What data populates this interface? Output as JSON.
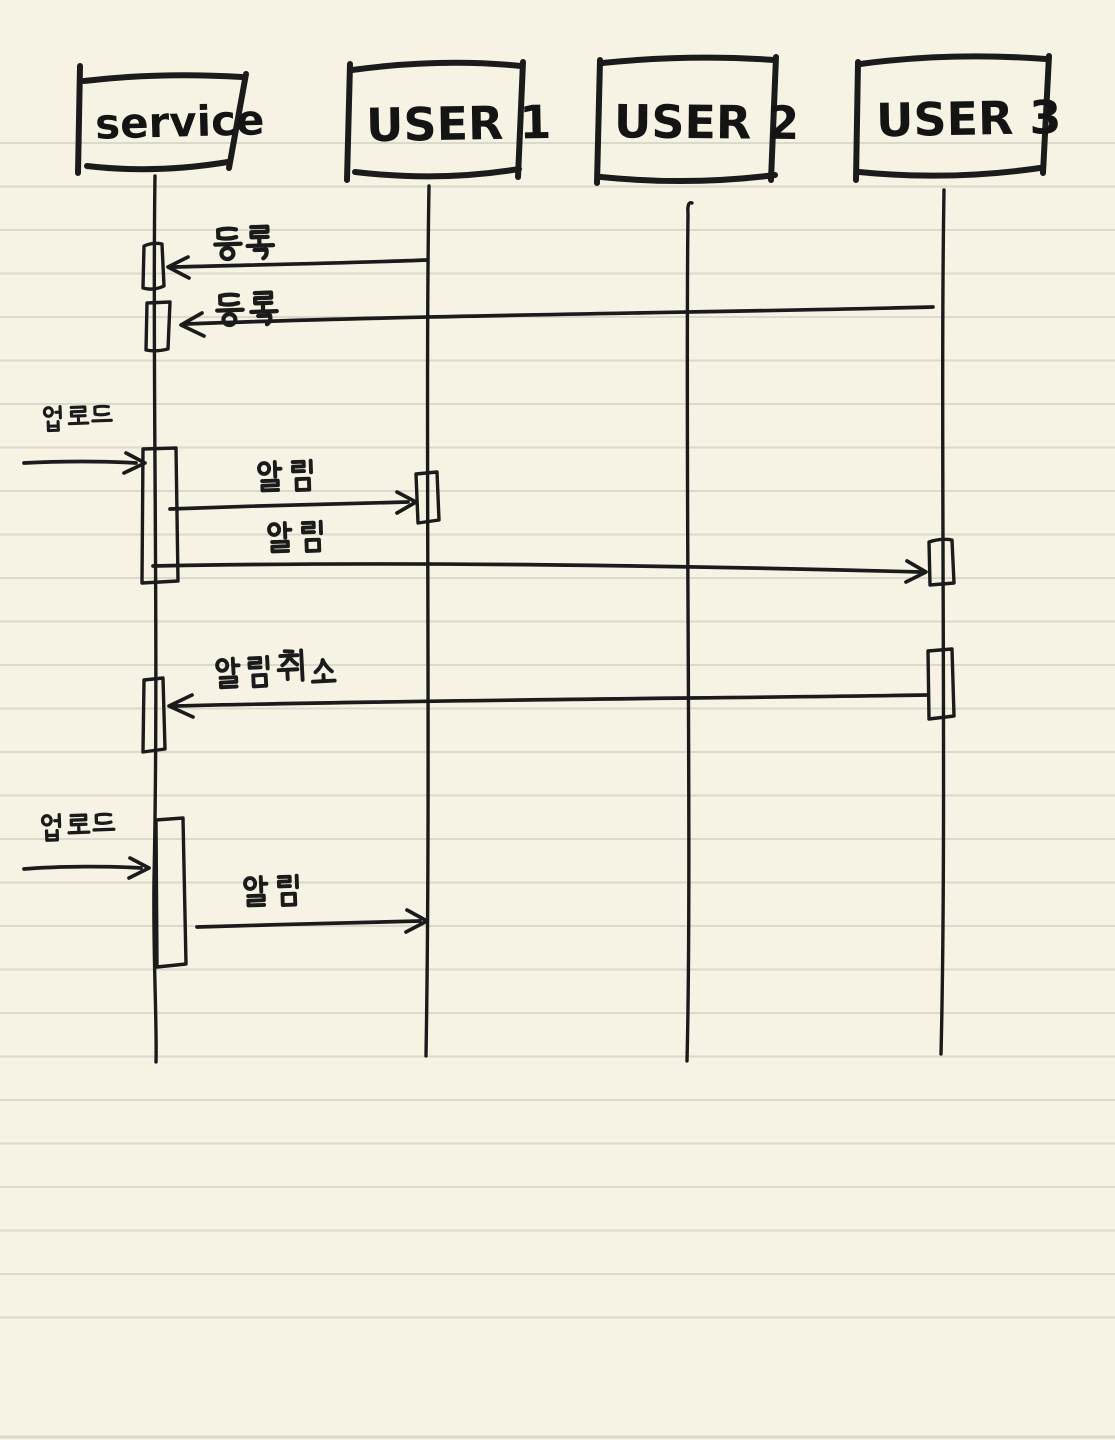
{
  "page": {
    "type": "handwritten-note",
    "background_color": "#f7f3e4",
    "ruled_line_color": "#dbd8cc",
    "ink_color": "#1b1b1b"
  },
  "diagram": {
    "kind": "sequence-diagram",
    "actors": [
      {
        "label": "service"
      },
      {
        "label": "USER 1"
      },
      {
        "label": "USER 2"
      },
      {
        "label": "USER 3"
      }
    ],
    "messages": [
      {
        "label": "등록",
        "from": "USER 1",
        "to": "service",
        "direction": "left"
      },
      {
        "label": "등록",
        "from": "USER 3",
        "to": "service",
        "direction": "left"
      },
      {
        "label": "업로드",
        "from": "outside",
        "to": "service",
        "direction": "right"
      },
      {
        "label": "알림",
        "from": "service",
        "to": "USER 1",
        "direction": "right"
      },
      {
        "label": "알림",
        "from": "service",
        "to": "USER 3",
        "direction": "right"
      },
      {
        "label": "알림 취소",
        "from": "USER 3",
        "to": "service",
        "direction": "left"
      },
      {
        "label": "업로드",
        "from": "outside",
        "to": "service",
        "direction": "right"
      },
      {
        "label": "알림",
        "from": "service",
        "to": "USER 1",
        "direction": "right"
      }
    ]
  }
}
